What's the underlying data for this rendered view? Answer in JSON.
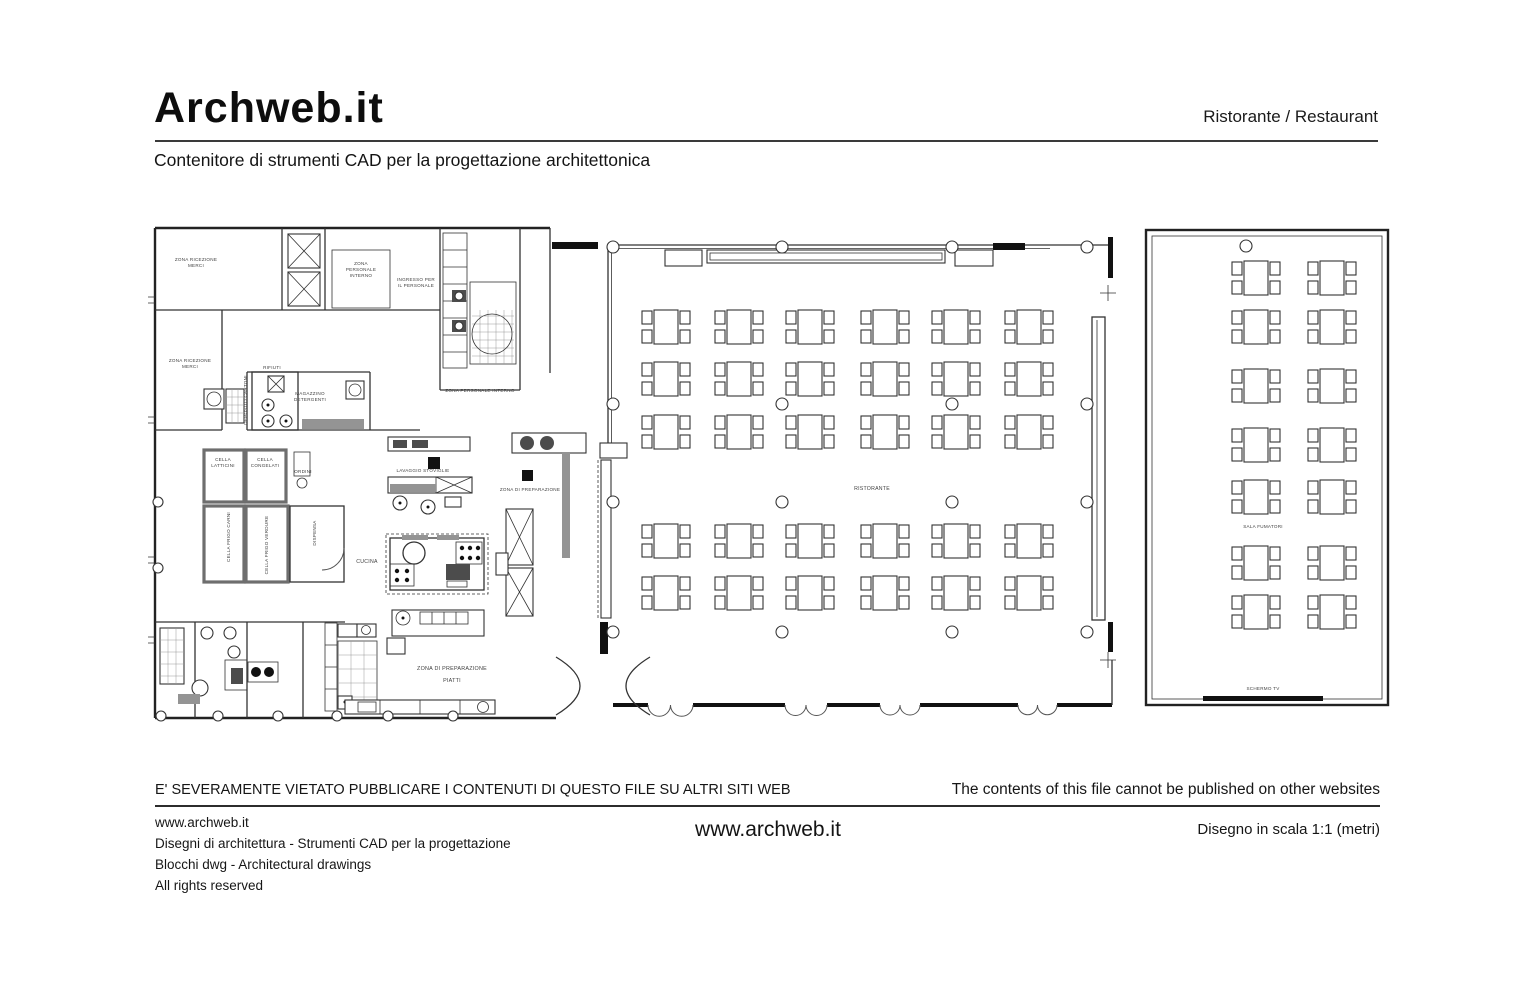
{
  "header": {
    "logo": "Archweb.it",
    "category": "Ristorante  /  Restaurant",
    "subtitle": "Contenitore di strumenti CAD per la progettazione architettonica"
  },
  "footer": {
    "warning_it": "E' SEVERAMENTE VIETATO PUBBLICARE I CONTENUTI DI QUESTO FILE SU ALTRI SITI WEB",
    "warning_en": "The contents of this file cannot be published on other websites",
    "site": "www.archweb.it",
    "line2": "Disegni di architettura - Strumenti CAD  per la progettazione",
    "line3": "Blocchi dwg - Architectural drawings",
    "line4": "All rights reserved",
    "site_center": "www.archweb.it",
    "scale_note": "Disegno in scala 1:1 (metri)"
  },
  "floorplan": {
    "labels": [
      {
        "text": "ZONA RICEZIONE",
        "x": 196,
        "y": 261
      },
      {
        "text": "MERCI",
        "x": 196,
        "y": 267
      },
      {
        "text": "ZONA",
        "x": 361,
        "y": 265
      },
      {
        "text": "PERSONALE",
        "x": 361,
        "y": 271
      },
      {
        "text": "INTERNO",
        "x": 361,
        "y": 277
      },
      {
        "text": "INGRESSO PER",
        "x": 416,
        "y": 281
      },
      {
        "text": "IL PERSONALE",
        "x": 416,
        "y": 287
      },
      {
        "text": "ZONA RICEZIONE",
        "x": 190,
        "y": 362
      },
      {
        "text": "MERCI",
        "x": 190,
        "y": 368
      },
      {
        "text": "RIFIUTI",
        "x": 272,
        "y": 369
      },
      {
        "text": "DEPOSITO CARTONI",
        "x": 247,
        "y": 400,
        "rot": -90
      },
      {
        "text": "MAGAZZINO",
        "x": 310,
        "y": 395
      },
      {
        "text": "DETERGENTI",
        "x": 310,
        "y": 401
      },
      {
        "text": "ZONA PERSONALE INTERNO",
        "x": 480,
        "y": 392
      },
      {
        "text": "CELLA",
        "x": 223,
        "y": 461
      },
      {
        "text": "LATTICINI",
        "x": 223,
        "y": 467
      },
      {
        "text": "CELLA",
        "x": 265,
        "y": 461
      },
      {
        "text": "CONGELATI",
        "x": 265,
        "y": 467
      },
      {
        "text": "ORDINI",
        "x": 303,
        "y": 473
      },
      {
        "text": "CELLA FRIGO CARNI",
        "x": 230,
        "y": 537,
        "rot": -90
      },
      {
        "text": "CELLA FRIGO VERDURE",
        "x": 268,
        "y": 545,
        "rot": -90
      },
      {
        "text": "DISPENSA",
        "x": 316,
        "y": 533,
        "rot": -90
      },
      {
        "text": "CUCINA",
        "x": 367,
        "y": 563,
        "s": 5.2
      },
      {
        "text": "LAVAGGIO STOVIGLIE",
        "x": 423,
        "y": 472
      },
      {
        "text": "ZONA DI PREPARAZIONE",
        "x": 530,
        "y": 491
      },
      {
        "text": "ZONA DI PREPARAZIONE",
        "x": 452,
        "y": 670,
        "s": 5.4
      },
      {
        "text": "PIATTI",
        "x": 452,
        "y": 682,
        "s": 5.4
      },
      {
        "text": "RISTORANTE",
        "x": 872,
        "y": 490,
        "s": 5.2
      },
      {
        "text": "SALA FUMATORI",
        "x": 1263,
        "y": 528
      },
      {
        "text": "SCHERMO  TV",
        "x": 1263,
        "y": 690
      }
    ],
    "dining_tables": {
      "cols_x": [
        666,
        739,
        810,
        885,
        956,
        1029
      ],
      "rows_y": [
        327,
        379,
        432,
        541,
        593
      ]
    },
    "smoking_tables": {
      "cols_x": [
        1256,
        1332
      ],
      "rows_y": [
        278,
        327,
        386,
        445,
        497,
        563,
        612
      ]
    },
    "columns": [
      [
        613,
        247
      ],
      [
        782,
        247
      ],
      [
        952,
        247
      ],
      [
        1087,
        247
      ],
      [
        613,
        404
      ],
      [
        782,
        404
      ],
      [
        952,
        404
      ],
      [
        1087,
        404
      ],
      [
        613,
        502
      ],
      [
        782,
        502
      ],
      [
        952,
        502
      ],
      [
        1087,
        502
      ],
      [
        613,
        632
      ],
      [
        782,
        632
      ],
      [
        952,
        632
      ],
      [
        1087,
        632
      ],
      [
        1246,
        246
      ]
    ],
    "wall_columns": [
      [
        161,
        716
      ],
      [
        218,
        716
      ],
      [
        278,
        716
      ],
      [
        337,
        716
      ],
      [
        388,
        716
      ],
      [
        453,
        716
      ],
      [
        158,
        502
      ],
      [
        158,
        568
      ]
    ],
    "doors": [
      [
        648,
        693
      ],
      [
        785,
        827
      ],
      [
        880,
        920
      ],
      [
        1018,
        1057
      ]
    ]
  }
}
